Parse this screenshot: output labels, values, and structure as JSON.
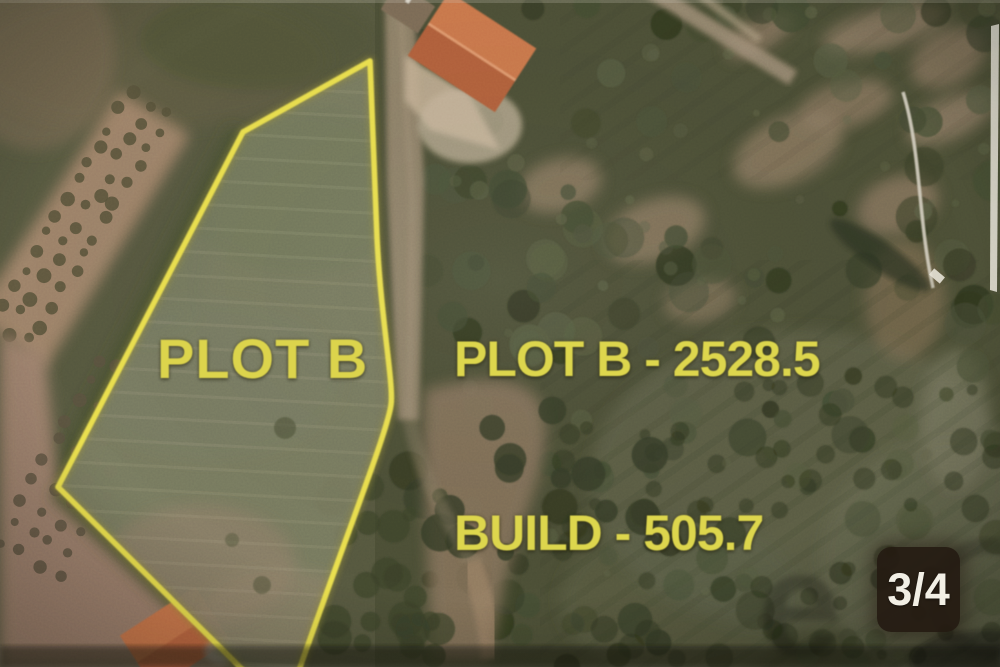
{
  "photo": {
    "kind_label": "aerial-photo",
    "plot_label": "PLOT B",
    "annotations": {
      "area_line_1": "PLOT B - 2528.5",
      "area_line_2": "BUILD - 505.7",
      "plot_area_value": "2528.5",
      "build_area_value": "505.7"
    },
    "page_indicator": {
      "label": "3/4"
    },
    "watermark": {
      "letter": "e"
    },
    "colors": {
      "annotation_yellow": "#ddd64d",
      "outline_yellow": "#eadf4e",
      "badge_background": "#241a11",
      "badge_text": "#f2efe5",
      "terrain_olive": "#55573f",
      "forest_dark": "#4b4e36",
      "field_pink": "#a8886f",
      "roof_orange": "#bd6a42"
    }
  }
}
